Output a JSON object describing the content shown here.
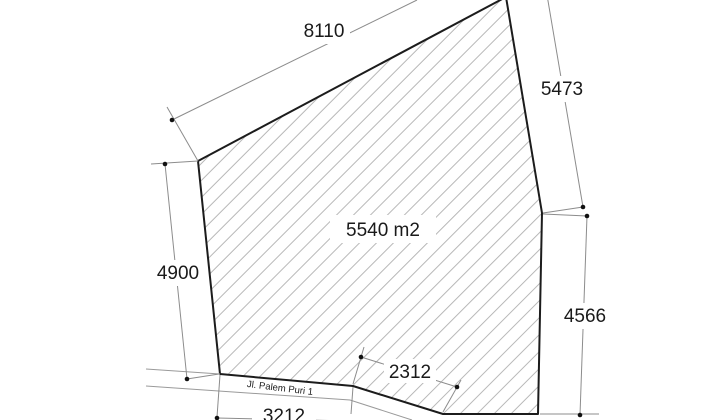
{
  "diagram": {
    "kind": "land-plot-survey-sketch",
    "area_label": "5540 m2",
    "road_label": "Jl. Palem Puri 1",
    "dimensions": {
      "top": "8110",
      "right_upper": "5473",
      "right_lower": "4566",
      "left": "4900",
      "bottom_slope": "2312",
      "bottom_left_partial": "3212"
    },
    "colors": {
      "outline": "#1c1c1c",
      "hatch": "#b8b8b8",
      "dimension_line": "#8c8c8c",
      "road_line": "#9a9a9a",
      "text": "#1a1a1a",
      "background": "#ffffff"
    }
  }
}
